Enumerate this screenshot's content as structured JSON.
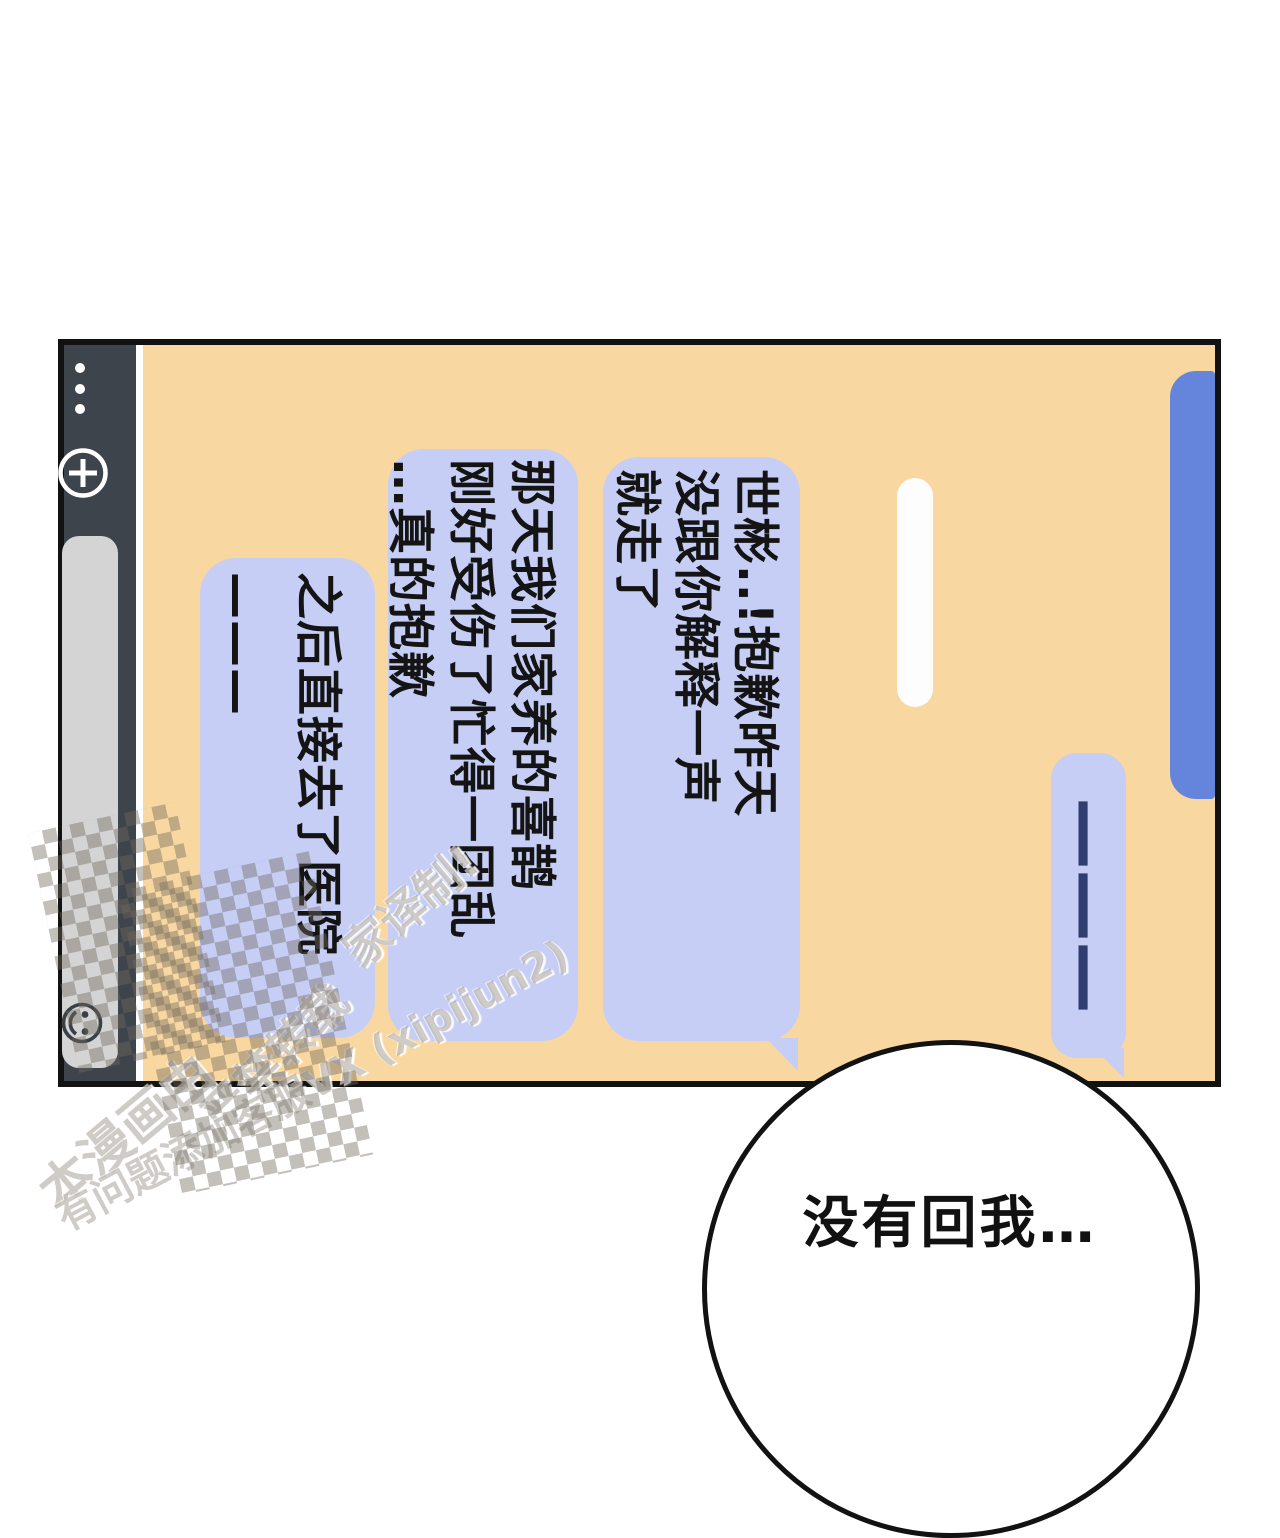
{
  "phone": {
    "toolbar": {
      "more_icon": "three-dots-more",
      "plus_icon": "add-attachment",
      "input_value": "",
      "emoji_icon": "smiley-face"
    },
    "messages": [
      {
        "type": "sent-blue",
        "text": ""
      },
      {
        "type": "received",
        "text": "———"
      },
      {
        "type": "sent-white",
        "text": ""
      },
      {
        "type": "received",
        "text": "世彬..!抱歉昨天\n没跟你解释一声\n就走了"
      },
      {
        "type": "received",
        "text": "那天我们家养的喜鹊\n刚好受伤了忙得一团乱\n…真的抱歉"
      },
      {
        "type": "received",
        "text": "之后直接去了医院\n———"
      }
    ]
  },
  "balloon": {
    "text": "没有回我…"
  },
  "watermark": {
    "fragments": [
      "本漫画由",
      "严禁转载",
      "家译制!",
      "有问题添加客服VX (xipijun2)"
    ]
  },
  "colors": {
    "screen_bg": "#f8d7a1",
    "received_bubble": "#c6cef6",
    "sent_bubble_blue": "#6584dc",
    "sent_bubble_white": "#fdfdfe",
    "toolbar_bg": "#3e444c",
    "input_bg": "#d4d4d4",
    "dash_line": "#2f3e6e",
    "outline": "#121212"
  }
}
